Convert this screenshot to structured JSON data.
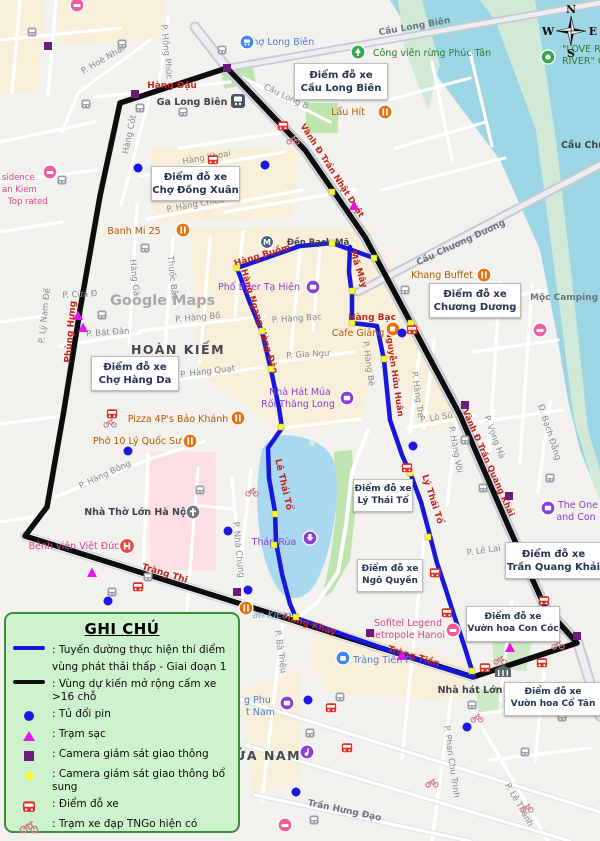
{
  "legend": {
    "title": "GHI CHÚ",
    "route_line1": ": Tuyến đường thực hiện thí điểm",
    "route_line2": "vùng phát thải thấp - Giai đoạn 1",
    "boundary": ": Vùng dự kiến mở rộng cấm xe >16 chỗ",
    "battery": ": Tủ đổi pin",
    "charging": ": Trạm sạc",
    "camera": ": Camera giám sát giao thông",
    "camera_extra": ": Camera giám sát giao thông bổ sung",
    "parking": ": Điểm đỗ xe",
    "tngo": ": Trạm xe đạp TNGo hiện có"
  },
  "parking_labels": [
    {
      "line1": "Điểm đỗ xe",
      "line2": "Cầu Long Biên"
    },
    {
      "line1": "Điểm đỗ xe",
      "line2": "Chợ Đồng Xuân"
    },
    {
      "line1": "Điểm đỗ xe",
      "line2": "Chương Dương"
    },
    {
      "line1": "Điểm đỗ xe",
      "line2": "Chợ Hàng Da"
    },
    {
      "line1": "Điểm đỗ xe",
      "line2": "Lý Thái Tổ"
    },
    {
      "line1": "Điểm đỗ xe",
      "line2": "Ngô Quyền"
    },
    {
      "line1": "Điểm đỗ xe",
      "line2": "Trần Quang Khải"
    },
    {
      "line1": "Điểm đỗ xe",
      "line2": "Vườn hoa Con Cóc"
    },
    {
      "line1": "Điểm đỗ xe",
      "line2": "Vườn hoa Cổ Tân"
    }
  ],
  "streets": {
    "hang_dau": "Hàng Đậu",
    "hoe_nhai": "P. Hoè Nhai",
    "hong_phuc": "P. Hồng Phúc",
    "hang_cot": "Hàng Cót",
    "hang_khoai": "Hàng Khoai",
    "hang_chieu": "P. Hàng Chiếu",
    "cau_long_bien": "Cầu Long Biên",
    "cau_long_bien_short": "Cầu Long B",
    "phung_hung": "Phùng Hưng",
    "ly_nam_de": "P. Lý Nam Đế",
    "hang_ga": "Hàng Gà",
    "thuoc_bac": "Thuốc Bắc",
    "bat_dan": "P. Bát Đàn",
    "hang_bo": "P. Hàng Bồ",
    "hang_quat": "P. Hàng Quạt",
    "cua_dong": "P. Cửa Đ",
    "hang_buom": "Hàng Buồm",
    "ma_may": "Mã Mây",
    "hang_ngang": "Hàng Ngang Hàng Đào",
    "hang_bac_p": "P. Hàng Bạc",
    "hang_bac": "Hàng Bạc",
    "gia_ngu": "P. Gia Ngư",
    "hang_be": "P. Hàng Bè",
    "nguyen_huu_huan": "Nguyễn Hữu Huân",
    "hang_tre": "P. Hàng Tre",
    "tran_nhat_duat": "Vành Đ Trần Nhật Duật",
    "cau_chuong_duong": "Cầu Chương Dương",
    "hang_bong": "P. Hàng Bông",
    "trang_thi": "Tràng Thi",
    "nha_chung": "P. Nhà Chung",
    "le_thai_to": "Lê Thái Tổ",
    "ly_thai_to": "Lý Thái Tổ",
    "lo_su": "P. Lò Sũ",
    "hang_voi": "P. Hàng Vôi",
    "vong_ha": "P. Vọng Hà",
    "bach_dang": "Đ. Bạch Đằng",
    "tran_quang_khai": "Vành Đ Trần Quang Khải",
    "le_lai": "P. Lê Lai",
    "trang_tien": "Tràng Tiền",
    "hang_khay": "Hàng Khay",
    "phan_chu_trinh": "P. Phan Chu Trinh",
    "tran_hung_dao": "Trần Hưng Đạo",
    "le_thanh": "P. Lê Thánh",
    "ba_trieu": "P. Bà Triệu"
  },
  "places": {
    "cho_long_bien": "Chợ Long Biên",
    "cong_vien": "Công viên rừng Phúc Tân",
    "love_river_1": "\"LOVE R",
    "love_river_2": "RIVER\" C",
    "cau_chuong_duong_place": "Cầu Chương Dương",
    "ga_long_bien": "Ga Long Biên",
    "lau_hit": "Lẩu Hít",
    "den_bach_ma": "Đền Bạch Mã",
    "ta_hien": "Phố Beer Tạ Hiện",
    "cafe_giang": "Cafe Giảng",
    "khang_buffet": "Khang Buffet",
    "moc_camping": "Mộc Camping",
    "banh_mi": "Banh Mi 25",
    "hoan_kiem": "HOÀN KIẾM",
    "watermark": "Google Maps",
    "mua_roi_1": "Nhà Hát Múa",
    "mua_roi_2": "Rối Thăng Long",
    "pizza": "Pizza 4P's Bảo Khánh",
    "pho10": "Phở 10 Lý Quốc Sư",
    "nha_tho": "Nhà Thờ Lớn Hà Nội",
    "viet_duc": "Bệnh viện Việt Đức",
    "thap_rua": "Tháp Rùa",
    "the_one_1": "The One",
    "the_one_2": "and Con",
    "sofitel_1": "Sofitel Legend",
    "sofitel_2": "Metropole Hanoi",
    "trang_tien_plaza": "Tràng Tiền P",
    "nha_hat_lon": "Nhà hát Lớn",
    "cua_nam": "ỬA NAM",
    "an_kiem": "an Kiem",
    "g_phu": "g Phu",
    "t_nam": "t Nam",
    "residence_1": "sidence",
    "residence_2": "an Kiem",
    "residence_3": "Top rated",
    "metro_m": "M"
  },
  "compass": {
    "n": "N",
    "e": "E",
    "s": "S",
    "w": "W"
  },
  "colors": {
    "route_blue": "#1616dd",
    "boundary_black": "#0d0d0d",
    "battery_blue": "#1a1adf",
    "charging_magenta": "#e516e5",
    "camera_purple": "#6d1b7b",
    "camera_extra_yellow": "#f6f63c",
    "parking_red": "#df3226",
    "tngo_pink": "#cf7f8a",
    "legend_bg": "#cdf2cd",
    "legend_border": "#3d8b3d",
    "river": "#9cd6e4",
    "lake": "#a9d9ef"
  }
}
